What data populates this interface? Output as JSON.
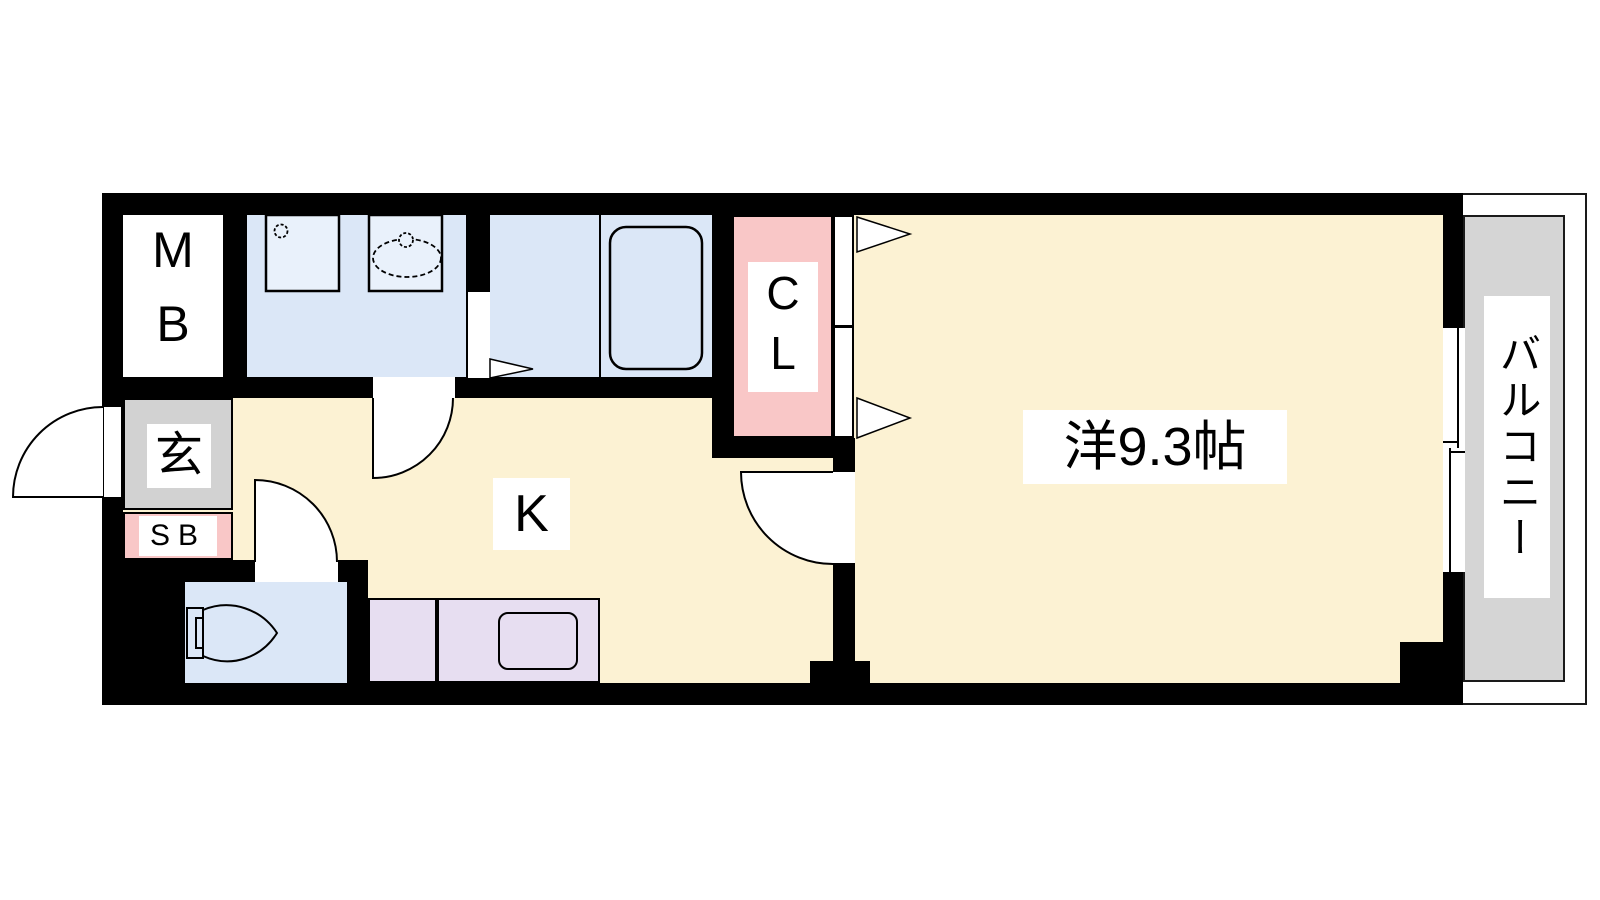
{
  "labels": {
    "meter_box": "MB",
    "closet": "CL",
    "entrance": "玄",
    "shoe_box": "SB",
    "kitchen": "K",
    "western_room": "洋9.3帖",
    "balcony": "バルコニー"
  },
  "fixtures": [
    "washing-machine-space",
    "wash-basin",
    "bathtub",
    "toilet",
    "kitchen-sink",
    "entrance-door-swing",
    "washroom-door-swing",
    "toilet-door-swing",
    "western-room-door-swing",
    "closet-folding-doors",
    "bathroom-folding-door",
    "sliding-window"
  ],
  "palette": {
    "wall": "#000000",
    "floor_cream": "#fcf2d3",
    "wet_area_blue": "#dbe7f7",
    "fixture_blue": "#e9f1fb",
    "closet_pink": "#f9c7c7",
    "entrance_gray": "#d2d2d2",
    "balcony_gray": "#d5d5d5",
    "counter_purple": "#e7def1",
    "label_bg": "#ffffff"
  }
}
